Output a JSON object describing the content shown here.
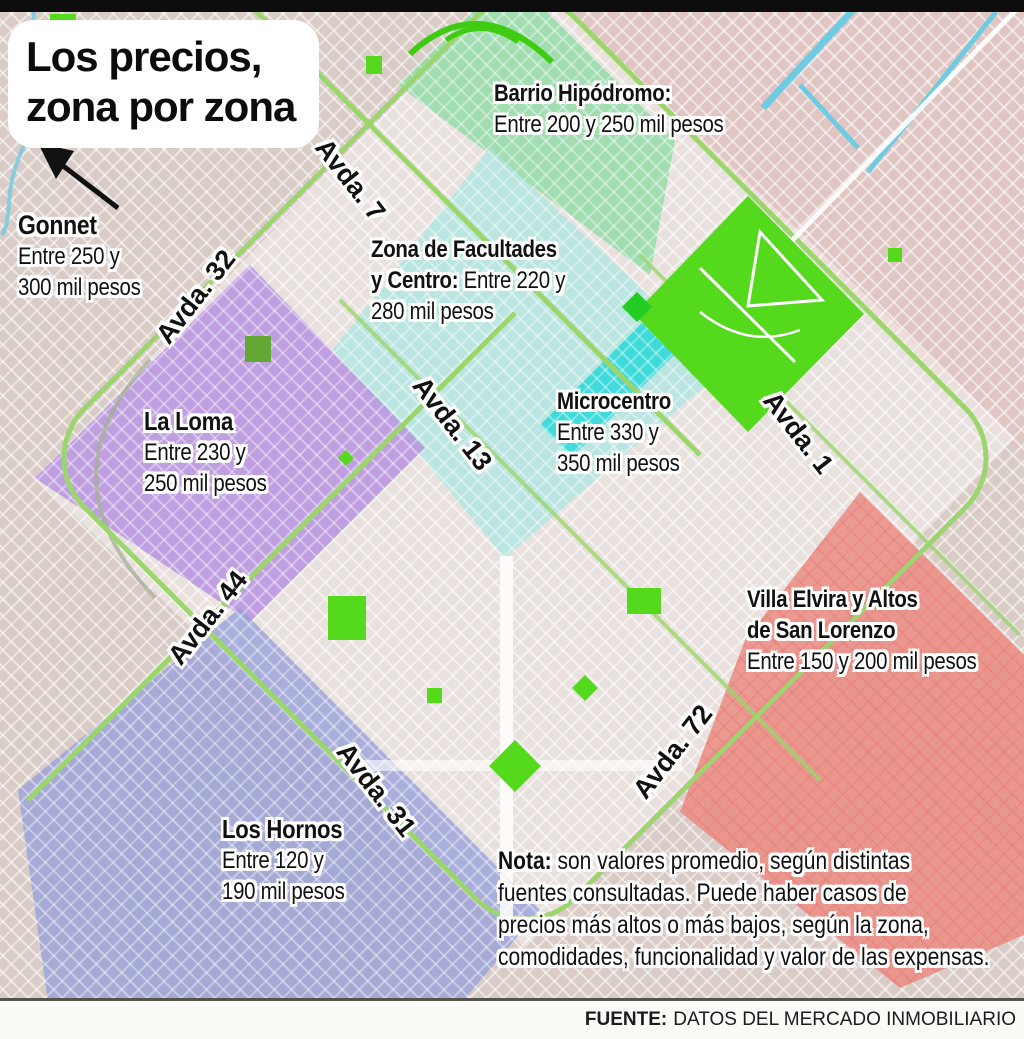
{
  "title": {
    "line1": "Los precios,",
    "line2": "zona por zona"
  },
  "zones": {
    "gonnet": {
      "name": "Gonnet",
      "price_line1": "Entre 250 y",
      "price_line2": "300 mil pesos"
    },
    "hipodromo": {
      "name": "Barrio Hipódromo:",
      "price_line1": "Entre 200 y 250 mil pesos",
      "color": "#8fdca6"
    },
    "facultades": {
      "name_line1": "Zona de Facultades",
      "name_line2": "y Centro:",
      "price_inline": "Entre 220 y",
      "price_line2": "280 mil pesos",
      "color": "#aee6e1"
    },
    "microcentro": {
      "name": "Microcentro",
      "price_line1": "Entre 330 y",
      "price_line2": "350 mil pesos",
      "color": "#35d9d9"
    },
    "la_loma": {
      "name": "La Loma",
      "price_line1": "Entre 230 y",
      "price_line2": "250 mil pesos",
      "color": "#b48fe0"
    },
    "villa_elvira": {
      "name_line1": "Villa Elvira y Altos",
      "name_line2": "de San Lorenzo",
      "price_line1": "Entre 150 y 200 mil pesos",
      "color": "#ec8d85"
    },
    "los_hornos": {
      "name": "Los Hornos",
      "price_line1": "Entre 120 y",
      "price_line2": "190 mil pesos",
      "color": "#99a2d9"
    }
  },
  "avenues": {
    "a7": "Avda. 7",
    "a32": "Avda. 32",
    "a13": "Avda. 13",
    "a1": "Avda. 1",
    "a44": "Avda. 44",
    "a72": "Avda. 72",
    "a31": "Avda. 31"
  },
  "note": {
    "label": "Nota:",
    "line1_rest": " son valores promedio, según distintas",
    "line2": "fuentes consultadas. Puede haber casos de",
    "line3": "precios más altos o más bajos, según la zona,",
    "line4": "comodidades, funcionalidad y valor de las expensas."
  },
  "source": {
    "label": "FUENTE:",
    "text": "DATOS DEL MERCADO INMOBILIARIO"
  },
  "map_colors": {
    "background": "#d9cbc6",
    "parks": "#55d91c",
    "roads": "#9cd56e",
    "water": "#6fcbe2"
  }
}
